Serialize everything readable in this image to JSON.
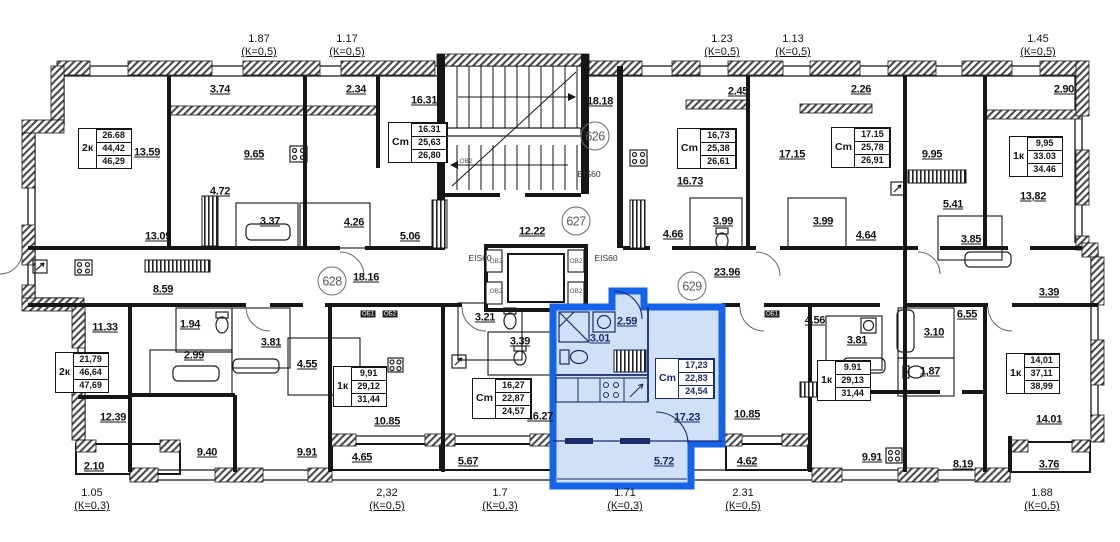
{
  "canvas": {
    "width": 1120,
    "height": 542,
    "background": "#ffffff"
  },
  "colors": {
    "walls": "#161616",
    "highlight_stroke": "#1563e8",
    "highlight_fill": "#cfe0f7",
    "highlight_text": "#1b2a6b"
  },
  "top_dimensions": [
    {
      "value": "1.87",
      "k": "(К=0,5)",
      "x": 259
    },
    {
      "value": "1.17",
      "k": "(К=0,5)",
      "x": 347
    },
    {
      "value": "1.23",
      "k": "(К=0,5)",
      "x": 722
    },
    {
      "value": "1.13",
      "k": "(К=0,5)",
      "x": 793
    },
    {
      "value": "1.45",
      "k": "(К=0,5)",
      "x": 1038
    }
  ],
  "bottom_dimensions": [
    {
      "value": "1.05",
      "k": "(К=0,3)",
      "x": 92
    },
    {
      "value": "2,32",
      "k": "(К=0,5)",
      "x": 387
    },
    {
      "value": "1.7",
      "k": "(К=0,3)",
      "x": 500
    },
    {
      "value": "1.71",
      "k": "(К=0,3)",
      "x": 625
    },
    {
      "value": "2.31",
      "k": "(К=0,5)",
      "x": 743
    },
    {
      "value": "1.88",
      "k": "(К=0,5)",
      "x": 1042
    }
  ],
  "unit_circles": [
    {
      "number": "626",
      "x": 595,
      "y": 136
    },
    {
      "number": "627",
      "x": 576,
      "y": 221
    },
    {
      "number": "628",
      "x": 332,
      "y": 281
    },
    {
      "number": "629",
      "x": 692,
      "y": 286
    }
  ],
  "apartment_boxes": [
    {
      "type": "2к",
      "rows": [
        "26.68",
        "44,42",
        "46,29"
      ],
      "x": 78,
      "y": 128
    },
    {
      "type": "Cm",
      "rows": [
        "16.31",
        "25,63",
        "26,80"
      ],
      "x": 388,
      "y": 122
    },
    {
      "type": "Cm",
      "rows": [
        "16,73",
        "25,38",
        "26,61"
      ],
      "x": 677,
      "y": 128
    },
    {
      "type": "Cm",
      "rows": [
        "17.15",
        "25,78",
        "26,91"
      ],
      "x": 831,
      "y": 127
    },
    {
      "type": "1к",
      "rows": [
        "9,95",
        "33.03",
        "34.46"
      ],
      "x": 1009,
      "y": 136
    },
    {
      "type": "2к",
      "rows": [
        "21,79",
        "46,64",
        "47,69"
      ],
      "x": 55,
      "y": 352
    },
    {
      "type": "1к",
      "rows": [
        "9,91",
        "29,12",
        "31,44"
      ],
      "x": 333,
      "y": 366
    },
    {
      "type": "Cm",
      "rows": [
        "16,27",
        "22,87",
        "24,57"
      ],
      "x": 472,
      "y": 378
    },
    {
      "type": "Cm",
      "rows": [
        "17,23",
        "22,83",
        "24,54"
      ],
      "x": 655,
      "y": 358,
      "highlight": true
    },
    {
      "type": "1к",
      "rows": [
        "9.91",
        "29,13",
        "31,44"
      ],
      "x": 817,
      "y": 360
    },
    {
      "type": "1к",
      "rows": [
        "14,01",
        "37,11",
        "38,99"
      ],
      "x": 1006,
      "y": 353
    }
  ],
  "room_areas": [
    {
      "text": "3.74",
      "x": 220,
      "y": 90
    },
    {
      "text": "2.34",
      "x": 356,
      "y": 90
    },
    {
      "text": "16.31",
      "x": 424,
      "y": 101
    },
    {
      "text": "18.18",
      "x": 600,
      "y": 102
    },
    {
      "text": "2.45",
      "x": 738,
      "y": 92
    },
    {
      "text": "2.26",
      "x": 861,
      "y": 90
    },
    {
      "text": "2.90",
      "x": 1064,
      "y": 90
    },
    {
      "text": "13.59",
      "x": 147,
      "y": 153
    },
    {
      "text": "9.65",
      "x": 254,
      "y": 155
    },
    {
      "text": "17.15",
      "x": 792,
      "y": 155
    },
    {
      "text": "9.95",
      "x": 932,
      "y": 155
    },
    {
      "text": "16.73",
      "x": 690,
      "y": 182
    },
    {
      "text": "4.72",
      "x": 220,
      "y": 192
    },
    {
      "text": "13,82",
      "x": 1033,
      "y": 197
    },
    {
      "text": "5.41",
      "x": 953,
      "y": 205
    },
    {
      "text": "3.37",
      "x": 270,
      "y": 222
    },
    {
      "text": "4.26",
      "x": 354,
      "y": 223
    },
    {
      "text": "5.06",
      "x": 410,
      "y": 237
    },
    {
      "text": "13.09",
      "x": 158,
      "y": 237
    },
    {
      "text": "12.22",
      "x": 532,
      "y": 232
    },
    {
      "text": "3.99",
      "x": 723,
      "y": 222
    },
    {
      "text": "3.99",
      "x": 823,
      "y": 222
    },
    {
      "text": "4.66",
      "x": 673,
      "y": 235
    },
    {
      "text": "4.64",
      "x": 866,
      "y": 236
    },
    {
      "text": "3.85",
      "x": 971,
      "y": 240
    },
    {
      "text": "18.16",
      "x": 366,
      "y": 278
    },
    {
      "text": "23.96",
      "x": 727,
      "y": 273
    },
    {
      "text": "8.59",
      "x": 163,
      "y": 290
    },
    {
      "text": "3.39",
      "x": 1049,
      "y": 293
    },
    {
      "text": "11.33",
      "x": 105,
      "y": 328
    },
    {
      "text": "1.94",
      "x": 190,
      "y": 325
    },
    {
      "text": "3.21",
      "x": 485,
      "y": 318
    },
    {
      "text": "2.59",
      "x": 627,
      "y": 322,
      "blue": true
    },
    {
      "text": "6.55",
      "x": 967,
      "y": 315
    },
    {
      "text": "4.56",
      "x": 815,
      "y": 321
    },
    {
      "text": "3.10",
      "x": 934,
      "y": 333
    },
    {
      "text": "3.01",
      "x": 600,
      "y": 339,
      "blue": true
    },
    {
      "text": "3.39",
      "x": 520,
      "y": 342
    },
    {
      "text": "3.81",
      "x": 271,
      "y": 343
    },
    {
      "text": "3.81",
      "x": 857,
      "y": 341
    },
    {
      "text": "2.99",
      "x": 194,
      "y": 356
    },
    {
      "text": "4.55",
      "x": 307,
      "y": 365
    },
    {
      "text": "1,87",
      "x": 930,
      "y": 372
    },
    {
      "text": "12.39",
      "x": 113,
      "y": 418
    },
    {
      "text": "10.85",
      "x": 387,
      "y": 422
    },
    {
      "text": "16.27",
      "x": 540,
      "y": 417
    },
    {
      "text": "17.23",
      "x": 687,
      "y": 418,
      "blue": true
    },
    {
      "text": "10.85",
      "x": 747,
      "y": 415
    },
    {
      "text": "14.01",
      "x": 1049,
      "y": 420
    },
    {
      "text": "9.40",
      "x": 207,
      "y": 453
    },
    {
      "text": "9.91",
      "x": 307,
      "y": 453
    },
    {
      "text": "4.65",
      "x": 362,
      "y": 458
    },
    {
      "text": "5.67",
      "x": 468,
      "y": 462
    },
    {
      "text": "5.72",
      "x": 664,
      "y": 462,
      "blue": true
    },
    {
      "text": "4.62",
      "x": 747,
      "y": 462
    },
    {
      "text": "9.91",
      "x": 872,
      "y": 458
    },
    {
      "text": "8.19",
      "x": 963,
      "y": 465
    },
    {
      "text": "3.76",
      "x": 1049,
      "y": 465
    },
    {
      "text": "2.10",
      "x": 94,
      "y": 467
    }
  ],
  "wall_tags": [
    {
      "text": "EIS60",
      "x": 589,
      "y": 174
    },
    {
      "text": "EIS60",
      "x": 480,
      "y": 258
    },
    {
      "text": "EIS60",
      "x": 606,
      "y": 258
    },
    {
      "text": "ОВ2",
      "x": 466,
      "y": 162,
      "small": true
    },
    {
      "text": "ОВ2",
      "x": 496,
      "y": 262,
      "small": true
    },
    {
      "text": "ОВ2",
      "x": 576,
      "y": 262,
      "small": true
    },
    {
      "text": "ОВ2",
      "x": 496,
      "y": 292,
      "small": true
    },
    {
      "text": "ОВ2",
      "x": 576,
      "y": 292,
      "small": true
    },
    {
      "text": "ОБ1",
      "x": 368,
      "y": 314,
      "chip": true
    },
    {
      "text": "ОБ2",
      "x": 390,
      "y": 314,
      "chip": true
    },
    {
      "text": "ОБ1",
      "x": 772,
      "y": 314,
      "chip": true
    }
  ]
}
